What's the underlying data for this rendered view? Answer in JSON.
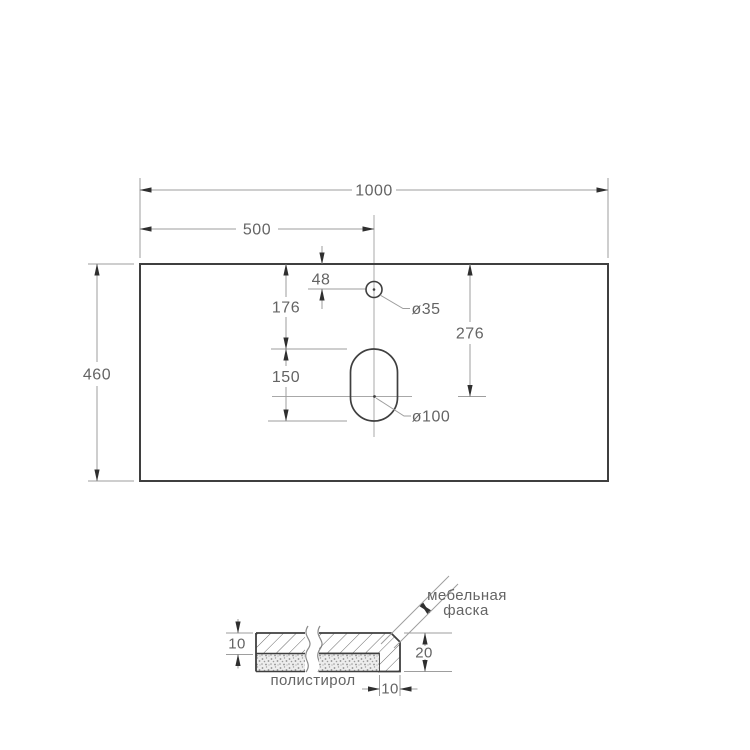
{
  "top_view": {
    "width": "1000",
    "center_offset": "500",
    "depth": "460",
    "faucet_offset": "48",
    "bowl_top_offset": "176",
    "bowl_center_offset": "276",
    "bowl_length": "150",
    "faucet_hole_diameter": "ø35",
    "bowl_hole_diameter": "ø100"
  },
  "section": {
    "top_thickness": "10",
    "edge_height": "20",
    "edge_width": "10",
    "chamfer_label_line1": "мебельная",
    "chamfer_label_line2": "фаска",
    "filler_label": "полистирол"
  },
  "colors": {
    "object_line": "#3f3f3f",
    "dimension_line": "#9e9e9e",
    "text": "#646464"
  }
}
